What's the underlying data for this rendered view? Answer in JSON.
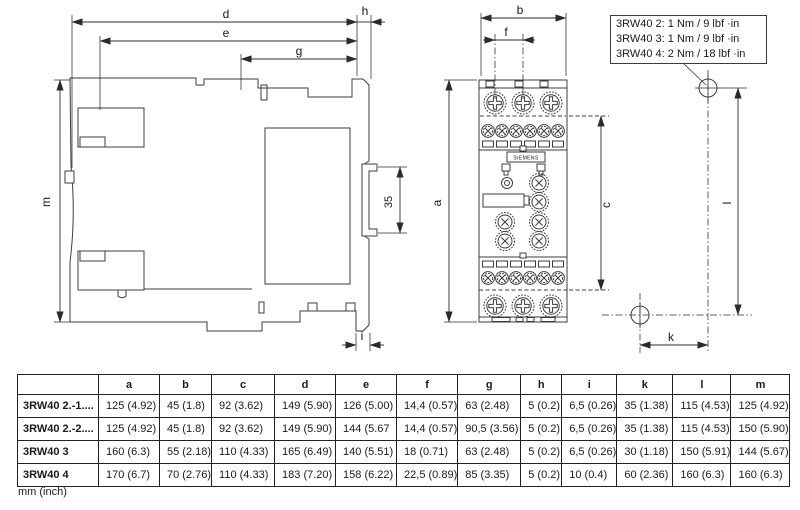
{
  "torque_box": {
    "lines": [
      "3RW40 2: 1 Nm / 9 lbf ·in",
      "3RW40 3: 1 Nm / 9 lbf ·in",
      "3RW40 4: 2 Nm / 18 lbf ·in"
    ]
  },
  "drawing": {
    "brand": "SIEMENS",
    "dims": {
      "d": "d",
      "e": "e",
      "g": "g",
      "h": "h",
      "m": "m",
      "rail": "35",
      "i": "i",
      "b": "b",
      "f": "f",
      "a": "a",
      "c": "c",
      "l": "l",
      "k": "k"
    },
    "line_color": "#3c3c3c"
  },
  "table": {
    "headers": [
      "",
      "a",
      "b",
      "c",
      "d",
      "e",
      "f",
      "g",
      "h",
      "i",
      "k",
      "l",
      "m"
    ],
    "rows": [
      {
        "label": "3RW40 2.-1....",
        "cells": [
          "125 (4.92)",
          "45 (1.8)",
          "92 (3.62)",
          "149 (5.90)",
          "126 (5.00)",
          "14,4 (0.57)",
          "63 (2.48)",
          "5 (0.2)",
          "6,5 (0.26)",
          "35 (1.38)",
          "115 (4.53)",
          "125 (4.92)"
        ]
      },
      {
        "label": "3RW40 2.-2....",
        "cells": [
          "125 (4.92)",
          "45 (1.8)",
          "92 (3.62)",
          "149 (5.90)",
          "144 (5.67",
          "14,4 (0.57)",
          "90,5 (3.56)",
          "5 (0.2)",
          "6,5 (0.26)",
          "35 (1.38)",
          "115 (4.53)",
          "150 (5.90)"
        ]
      },
      {
        "label": "3RW40 3",
        "cells": [
          "160 (6.3)",
          "55 (2.18)",
          "110 (4.33)",
          "165 (6.49)",
          "140 (5.51)",
          "18 (0.71)",
          "63 (2.48)",
          "5 (0.2)",
          "6,5 (0.26)",
          "30 (1.18)",
          "150 (5.91)",
          "144 (5.67)"
        ]
      },
      {
        "label": "3RW40 4",
        "cells": [
          "170 (6.7)",
          "70 (2.76)",
          "110 (4.33)",
          "183 (7.20)",
          "158 (6.22)",
          "22,5 (0.89)",
          "85 (3.35)",
          "5 (0.2)",
          "10 (0.4)",
          "60 (2.36)",
          "160 (6.3)",
          "160 (6.3)"
        ]
      }
    ],
    "unit_note": "mm (inch)"
  }
}
